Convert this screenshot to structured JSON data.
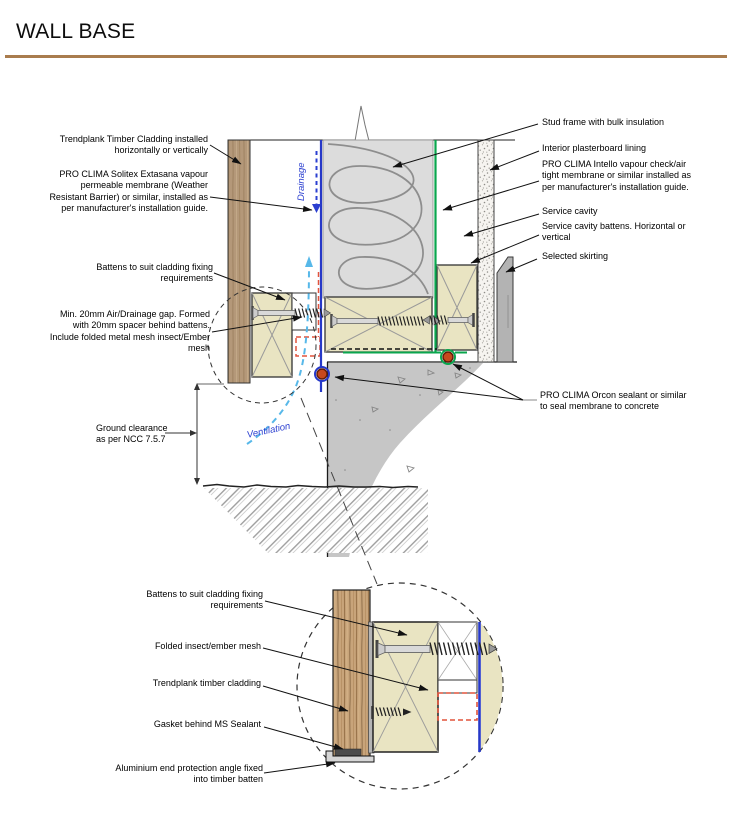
{
  "header": {
    "title": "WALL BASE"
  },
  "labels": {
    "left": [
      {
        "text": "Trendplank Timber Cladding installed\nhorizontally or vertically"
      },
      {
        "text": "PRO CLIMA Solitex Extasana vapour\npermeable membrane (Weather\nResistant Barrier) or similar, installed as\nper manufacturer's installation guide."
      },
      {
        "text": "Battens to suit cladding fixing\nrequirements"
      },
      {
        "text": "Min. 20mm Air/Drainage gap. Formed\nwith 20mm spacer behind battens.\nInclude folded metal mesh insect/Ember\nmesh"
      },
      {
        "text": "Ground clearance\nas per NCC 7.5.7"
      }
    ],
    "right": [
      {
        "text": "Stud frame with bulk insulation"
      },
      {
        "text": "Interior plasterboard lining"
      },
      {
        "text": "PRO CLIMA Intello vapour check/air\ntight membrane or similar installed as\nper manufacturer's installation guide."
      },
      {
        "text": "Service cavity"
      },
      {
        "text": "Service cavity battens. Horizontal or\nvertical"
      },
      {
        "text": "Selected skirting"
      },
      {
        "text": "PRO CLIMA Orcon sealant or similar\nto seal membrane to concrete"
      }
    ],
    "detail": [
      {
        "text": "Battens to suit cladding fixing\nrequirements"
      },
      {
        "text": "Folded insect/ember mesh"
      },
      {
        "text": "Trendplank timber cladding"
      },
      {
        "text": "Gasket behind MS Sealant"
      },
      {
        "text": "Aluminium end protection angle fixed\ninto timber batten"
      }
    ],
    "flow": {
      "drainage": "Drainage",
      "ventilation": "Ventilation"
    }
  },
  "colors": {
    "title_rule": "#a97c4e",
    "wrb_membrane_blue": "#2638c8",
    "intello_membrane_green": "#0aa64e",
    "orcon_sealant_orange": "#c7481d",
    "mesh_indicator_red": "#e2543c",
    "airflow_cyan": "#57b8e9",
    "timber": "#b49879",
    "batten_cream": "#e9e4c2",
    "concrete_grey": "#c6c6c6"
  }
}
